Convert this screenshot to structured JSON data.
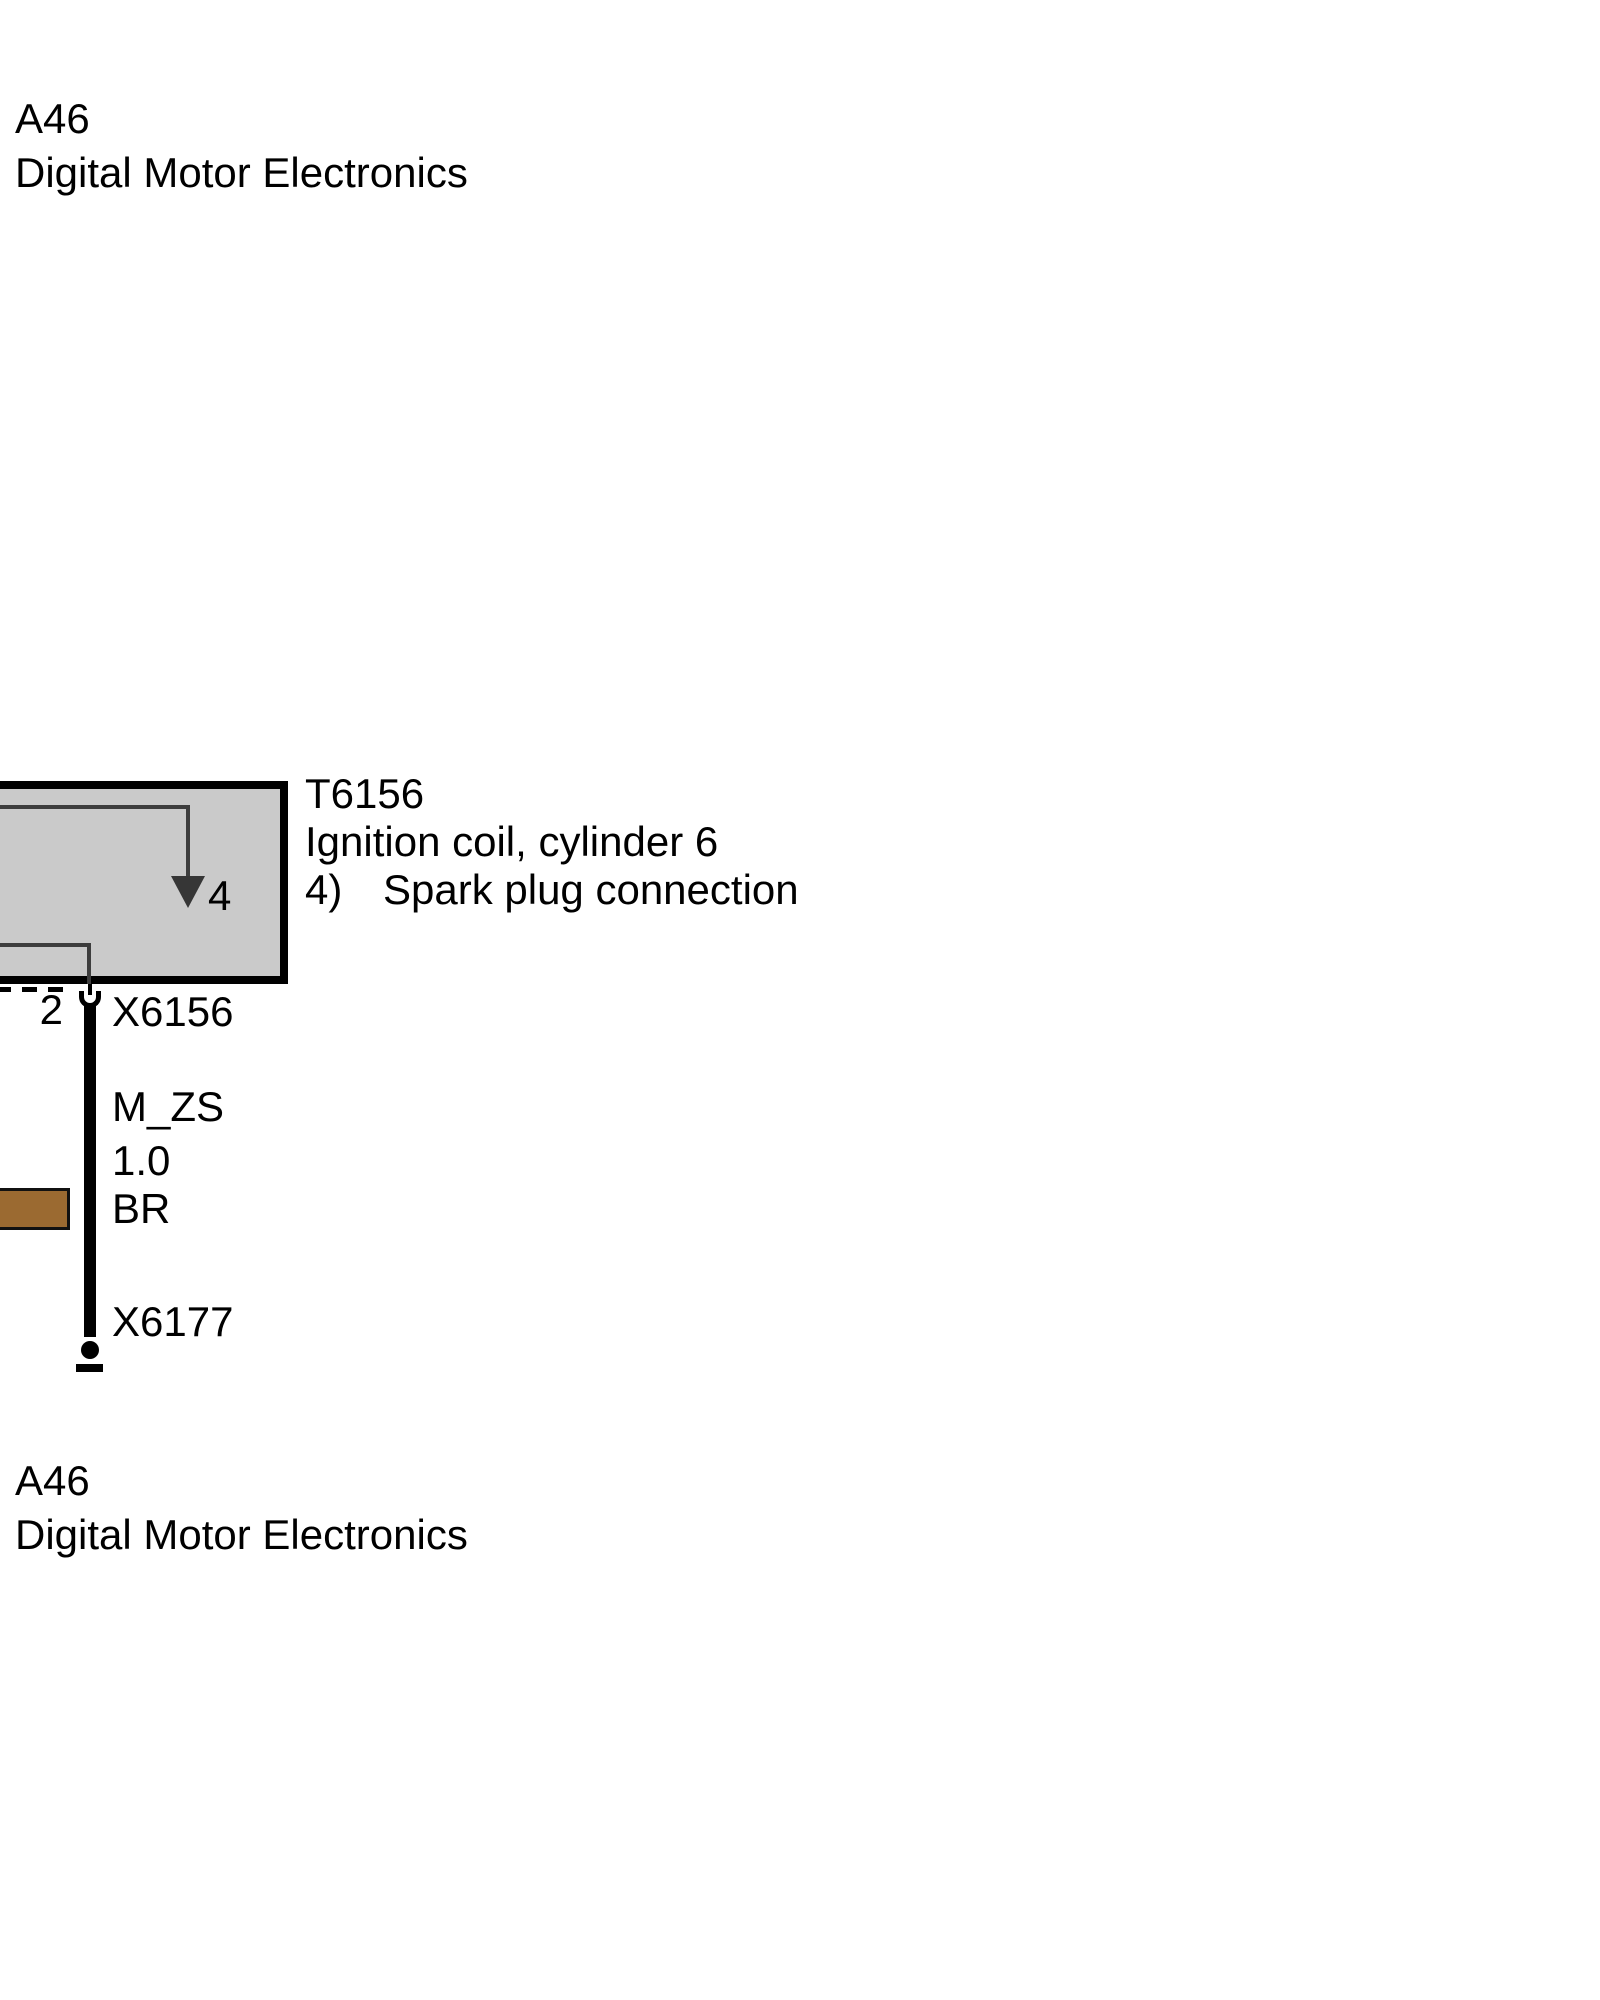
{
  "top_component": {
    "id": "A46",
    "name": "Digital Motor Electronics"
  },
  "ignition_coil": {
    "id": "T6156",
    "name": "Ignition coil, cylinder 6",
    "footnote_marker": "4)",
    "footnote_text": "Spark plug connection",
    "internal_pin_label": "4",
    "box_fill": "#cacaca",
    "trace_color": "#3d3d3d"
  },
  "connector_x6156": {
    "pin": "2",
    "id": "X6156"
  },
  "wire": {
    "signal": "M_ZS",
    "cross_section": "1.0",
    "color_code": "BR",
    "color_hex": "#9b6a31"
  },
  "connector_x6177": {
    "id": "X6177"
  },
  "bottom_component": {
    "id": "A46",
    "name": "Digital Motor Electronics"
  }
}
